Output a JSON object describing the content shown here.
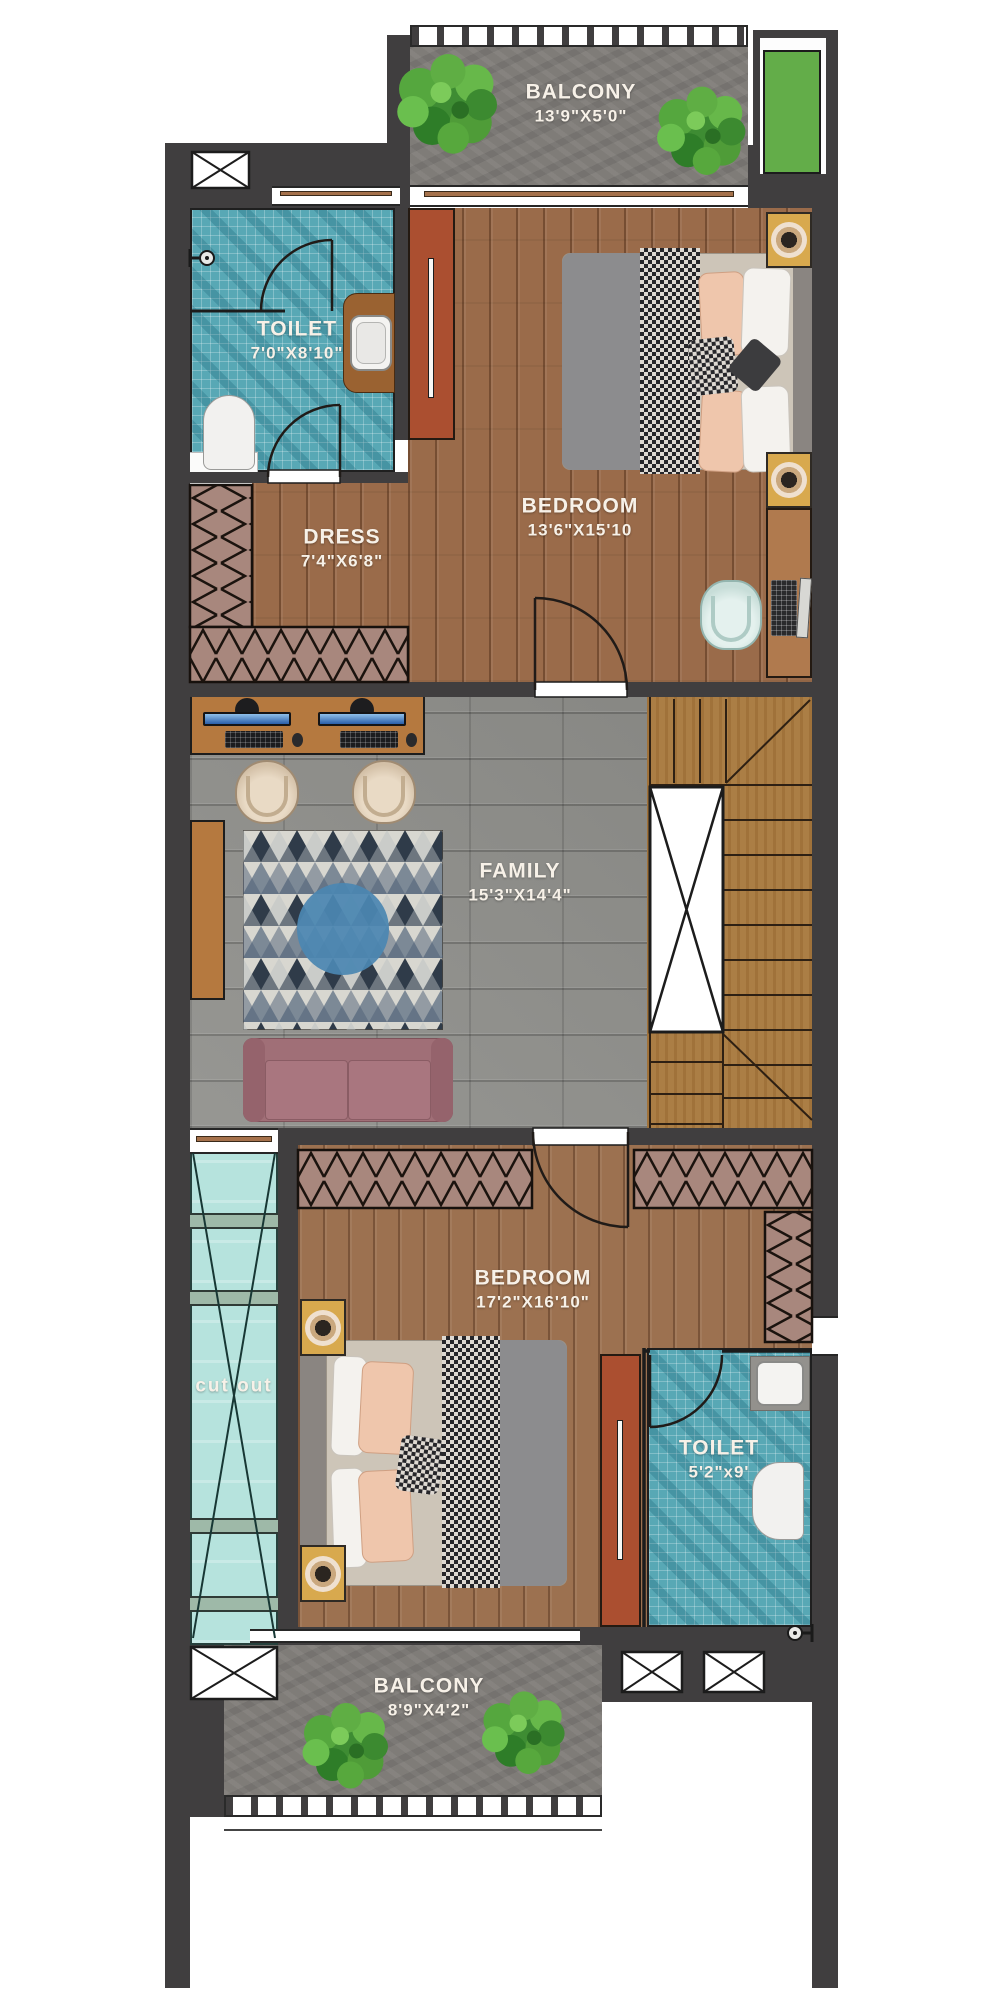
{
  "rooms": {
    "balcony_top": {
      "name": "BALCONY",
      "dims": "13'9\"X5'0\""
    },
    "toilet_top": {
      "name": "TOILET",
      "dims": "7'0\"X8'10\""
    },
    "bedroom_top": {
      "name": "BEDROOM",
      "dims": "13'6\"X15'10"
    },
    "dress": {
      "name": "DRESS",
      "dims": "7'4\"X6'8\""
    },
    "family": {
      "name": "FAMILY",
      "dims": "15'3\"X14'4\""
    },
    "bedroom_bottom": {
      "name": "BEDROOM",
      "dims": "17'2\"X16'10\""
    },
    "toilet_bottom": {
      "name": "TOILET",
      "dims": "5'2\"x9'"
    },
    "balcony_bottom": {
      "name": "BALCONY",
      "dims": "8'9\"X4'2\""
    },
    "cutout": {
      "name": "cut out"
    }
  },
  "colors": {
    "wall": "#403e3f",
    "wood_floor": "#9a6b4a",
    "teal_tile": "#58a8b5",
    "grey_tile": "#90908c",
    "balcony_grey": "#7f7c78",
    "planter_green": "#63ad49",
    "sofa": "#a06f77",
    "rug_blue": "#4b86b2",
    "wardrobe_rust": "#ab4f30",
    "label_text": "#f7f1e8"
  }
}
